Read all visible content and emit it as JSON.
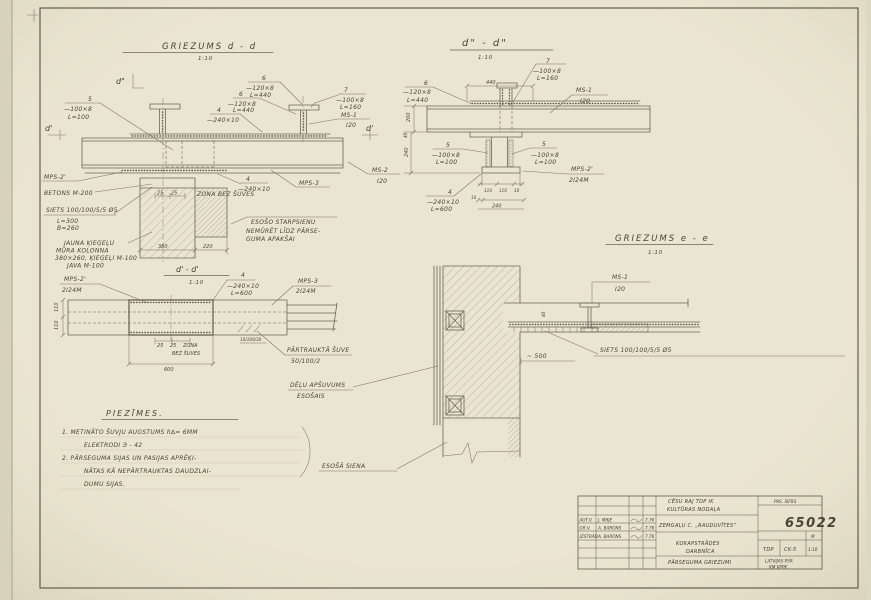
{
  "colors": {
    "paper": "#eae5d0",
    "line": "#6a6456",
    "text": "#494437",
    "number": "#8a4232"
  },
  "section_dd": {
    "title": "GRIEZUMS  d - d",
    "scale": "1:10",
    "marker_top": "d\"",
    "marker_left": "d'",
    "marker_right": "d'",
    "pos5": "5",
    "pos5_spec": "—100×8",
    "pos5_len": "L=100",
    "pos6a": "6",
    "pos6a_spec": "—120×8",
    "pos6a_len": "L=440",
    "pos6b": "6",
    "pos6b_spec": "—120×8",
    "pos6b_len": "L=440",
    "pos4a": "4",
    "pos4a_spec": "—240×10",
    "pos7": "7",
    "pos7_spec": "—100×8",
    "pos7_len": "L=160",
    "ms1": "MS-1",
    "ms1_profile": "I20",
    "ms2": "MS-2",
    "ms2_profile": "I20",
    "mps2": "MPS-2'",
    "betons": "BETONS M-200",
    "siets": "SIETS 100/100/5/5 Ø5",
    "siets_l": "L=300",
    "siets_b": "B=260",
    "col1": "JAUNA ĶIEĢEĻU",
    "col2": "MŪRA KOLONNA",
    "col3": "380×260, ĶIEĢEĻI M-100",
    "col4": "JAVA M-100",
    "pos4b": "4",
    "pos4b_spec": "—240×10",
    "d25a": "25",
    "d25b": "25",
    "zona": "ZONA BEZ ŠUVES",
    "mps3": "MPS-3",
    "starpsiena1": "ESOŠO STARPSIENU",
    "starpsiena2": "NEMŪRĒT LĪDZ PĀRSE-",
    "starpsiena3": "GUMA APAKŠAI",
    "dim380": "380",
    "dim220": "220"
  },
  "section_d1d1": {
    "title": "d' - d'",
    "scale": "1:10",
    "mps2": "MPS-2'",
    "mps2_profile": "2I24M",
    "pos4": "4",
    "pos4_spec": "—240×10",
    "pos4_len": "L=600",
    "mps3": "MPS-3",
    "mps3_profile": "2I24M",
    "dim110a": "110",
    "dim110b": "110",
    "d25a": "25",
    "d25b": "25",
    "zona1": "ZONA",
    "zona2": "BEZ ŠUVES",
    "weld_dims": "10/100/30",
    "seam1": "PĀRTRAUKTĀ ŠUVE",
    "seam2": "50/100/2",
    "dim600": "600",
    "delu1": "DĒĻU APŠUVUMS",
    "delu2": "ESOŠAIS"
  },
  "section_d2d2": {
    "title": "d\" - d\"",
    "scale": "1:10",
    "pos6": "6",
    "pos6_spec": "—120×8",
    "pos6_len": "L=440",
    "pos7": "7",
    "pos7_spec": "—100×8",
    "pos7_len": "L=160",
    "dim440": "440",
    "ms1": "MS-1",
    "ms1_profile": "I20",
    "pos5l": "5",
    "pos5l_spec": "—100×8",
    "pos5l_len": "L=100",
    "pos5r": "5",
    "pos5r_spec": "—100×8",
    "pos5r_len": "L=100",
    "mps2": "MPS-2'",
    "mps2_profile": "2I24M",
    "pos4": "4",
    "pos4_spec": "—240×10",
    "pos4_len": "L=600",
    "dim200": "200",
    "dim40": "40",
    "dim240v": "240",
    "dim110a": "110",
    "dim110b": "110",
    "dim10a": "10",
    "dim10b": "10",
    "dim240": "240"
  },
  "section_ee": {
    "title": "GRIEZUMS  e - e",
    "scale": "1:10",
    "ms1": "MS-1",
    "ms1_profile": "I20",
    "siets": "SIETS 100/100/5/5 Ø5",
    "dim500": "~ 500",
    "dim40": "40",
    "esosa_siena": "ESOŠĀ SIENA"
  },
  "notes": {
    "heading": "PIEZĪMES.",
    "n1a": "1.  METINĀTO ŠUVJU AUGSTUMS  h∆= 6MM",
    "n1b": "ELEKTRODI   Э - 42",
    "n2a": "2.  PĀRSEGUMA SIJAS UN PASIJAS APRĒĶI-",
    "n2b": "NĀTAS KĀ NEPĀRTRAUKTAS DAUDZLAI-",
    "n2c": "DUMU SIJAS."
  },
  "titleblock": {
    "client1": "CĒSU RAJ TDP IK",
    "client2": "KULTŪRAS NODAĻA",
    "pas_sifrs": "PAS. ŠIFRS",
    "number": "65022",
    "project": "ZEMGAĻU C. „RAUDUVĪTES”",
    "object1": "KOKAPSTRĀDES",
    "object2": "DARBNĪCA",
    "m_label": "M",
    "stage": "TDP",
    "sheet_code": "CK-5",
    "sheet_scale": "1:10",
    "sheet_title": "PĀRSEGUMA GRIEZUMI",
    "org1": "LATVIJAS PSR",
    "org2": "KM  KPPK",
    "rows": [
      {
        "role": "AUT.V.",
        "name": "J. MIĶE",
        "date": "7.76"
      },
      {
        "role": "GR.V.",
        "name": "A. BARONS",
        "date": "7.76"
      },
      {
        "role": "IZSTRĀD.",
        "name": "A. BARONS",
        "date": "7.76"
      }
    ]
  }
}
